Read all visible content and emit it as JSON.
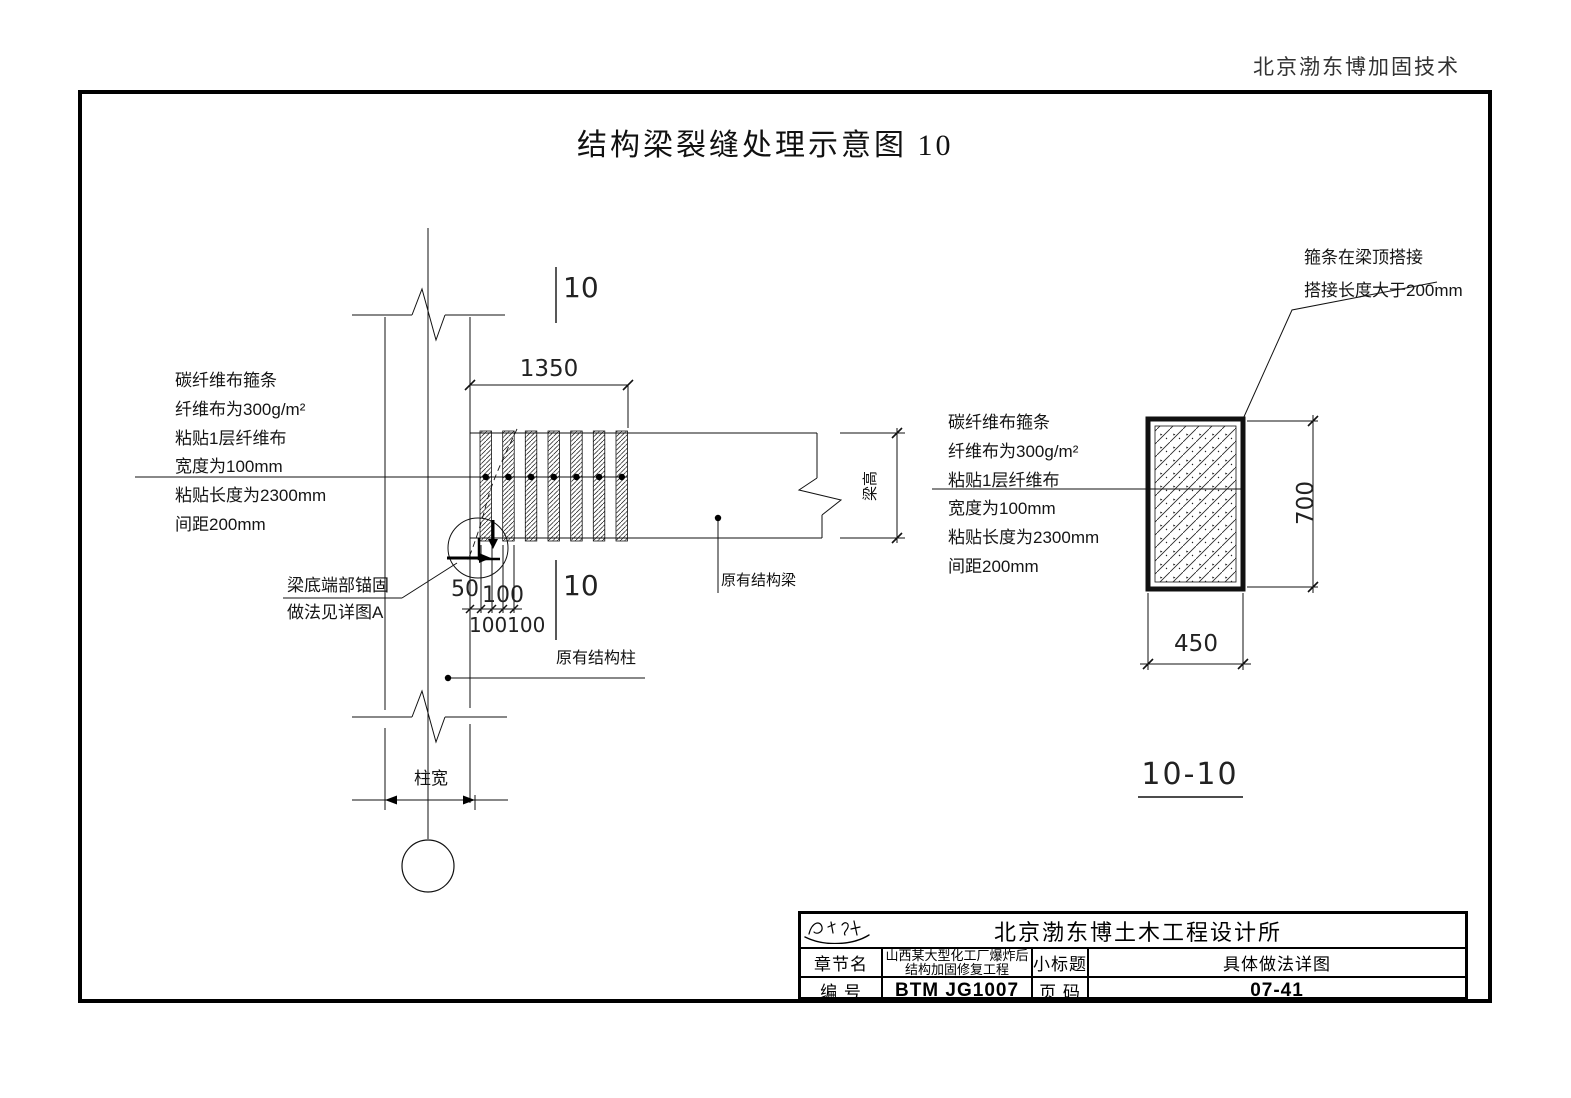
{
  "page": {
    "header": "北京渤东博加固技术",
    "title": "结构梁裂缝处理示意图  10"
  },
  "left_note": {
    "lines": [
      "碳纤维布箍条",
      "纤维布为300g/m²",
      "粘贴1层纤维布",
      "宽度为100mm",
      "粘贴长度为2300mm",
      "间距200mm"
    ]
  },
  "right_note": {
    "lines": [
      "碳纤维布箍条",
      "纤维布为300g/m²",
      "粘贴1层纤维布",
      "宽度为100mm",
      "粘贴长度为2300mm",
      "间距200mm"
    ]
  },
  "lap_note": {
    "line1": "箍条在梁顶搭接",
    "line2": "搭接长度大于200mm"
  },
  "anchor_note": {
    "line1": "梁底端部锚固",
    "line2": "做法见详图A"
  },
  "labels": {
    "existing_beam": "原有结构梁",
    "existing_column": "原有结构柱",
    "column_width": "柱宽",
    "beam_height": "梁高",
    "section_marker": "10",
    "section_title": "10-10"
  },
  "dimensions": {
    "wrap_length": "1350",
    "end_offset": "50",
    "strip_width": "100",
    "strip_pitch": "100100",
    "section_height": "700",
    "section_width": "450"
  },
  "title_block": {
    "company": "北京渤东博土木工程设计所",
    "row2": {
      "label1": "章节名",
      "project_line1": "山西某大型化工厂爆炸后",
      "project_line2": "结构加固修复工程",
      "label2": "小标题",
      "subtitle": "具体做法详图"
    },
    "row3": {
      "label1": "编  号",
      "code": "BTM JG1007",
      "label2": "页  码",
      "page": "07-41"
    }
  }
}
